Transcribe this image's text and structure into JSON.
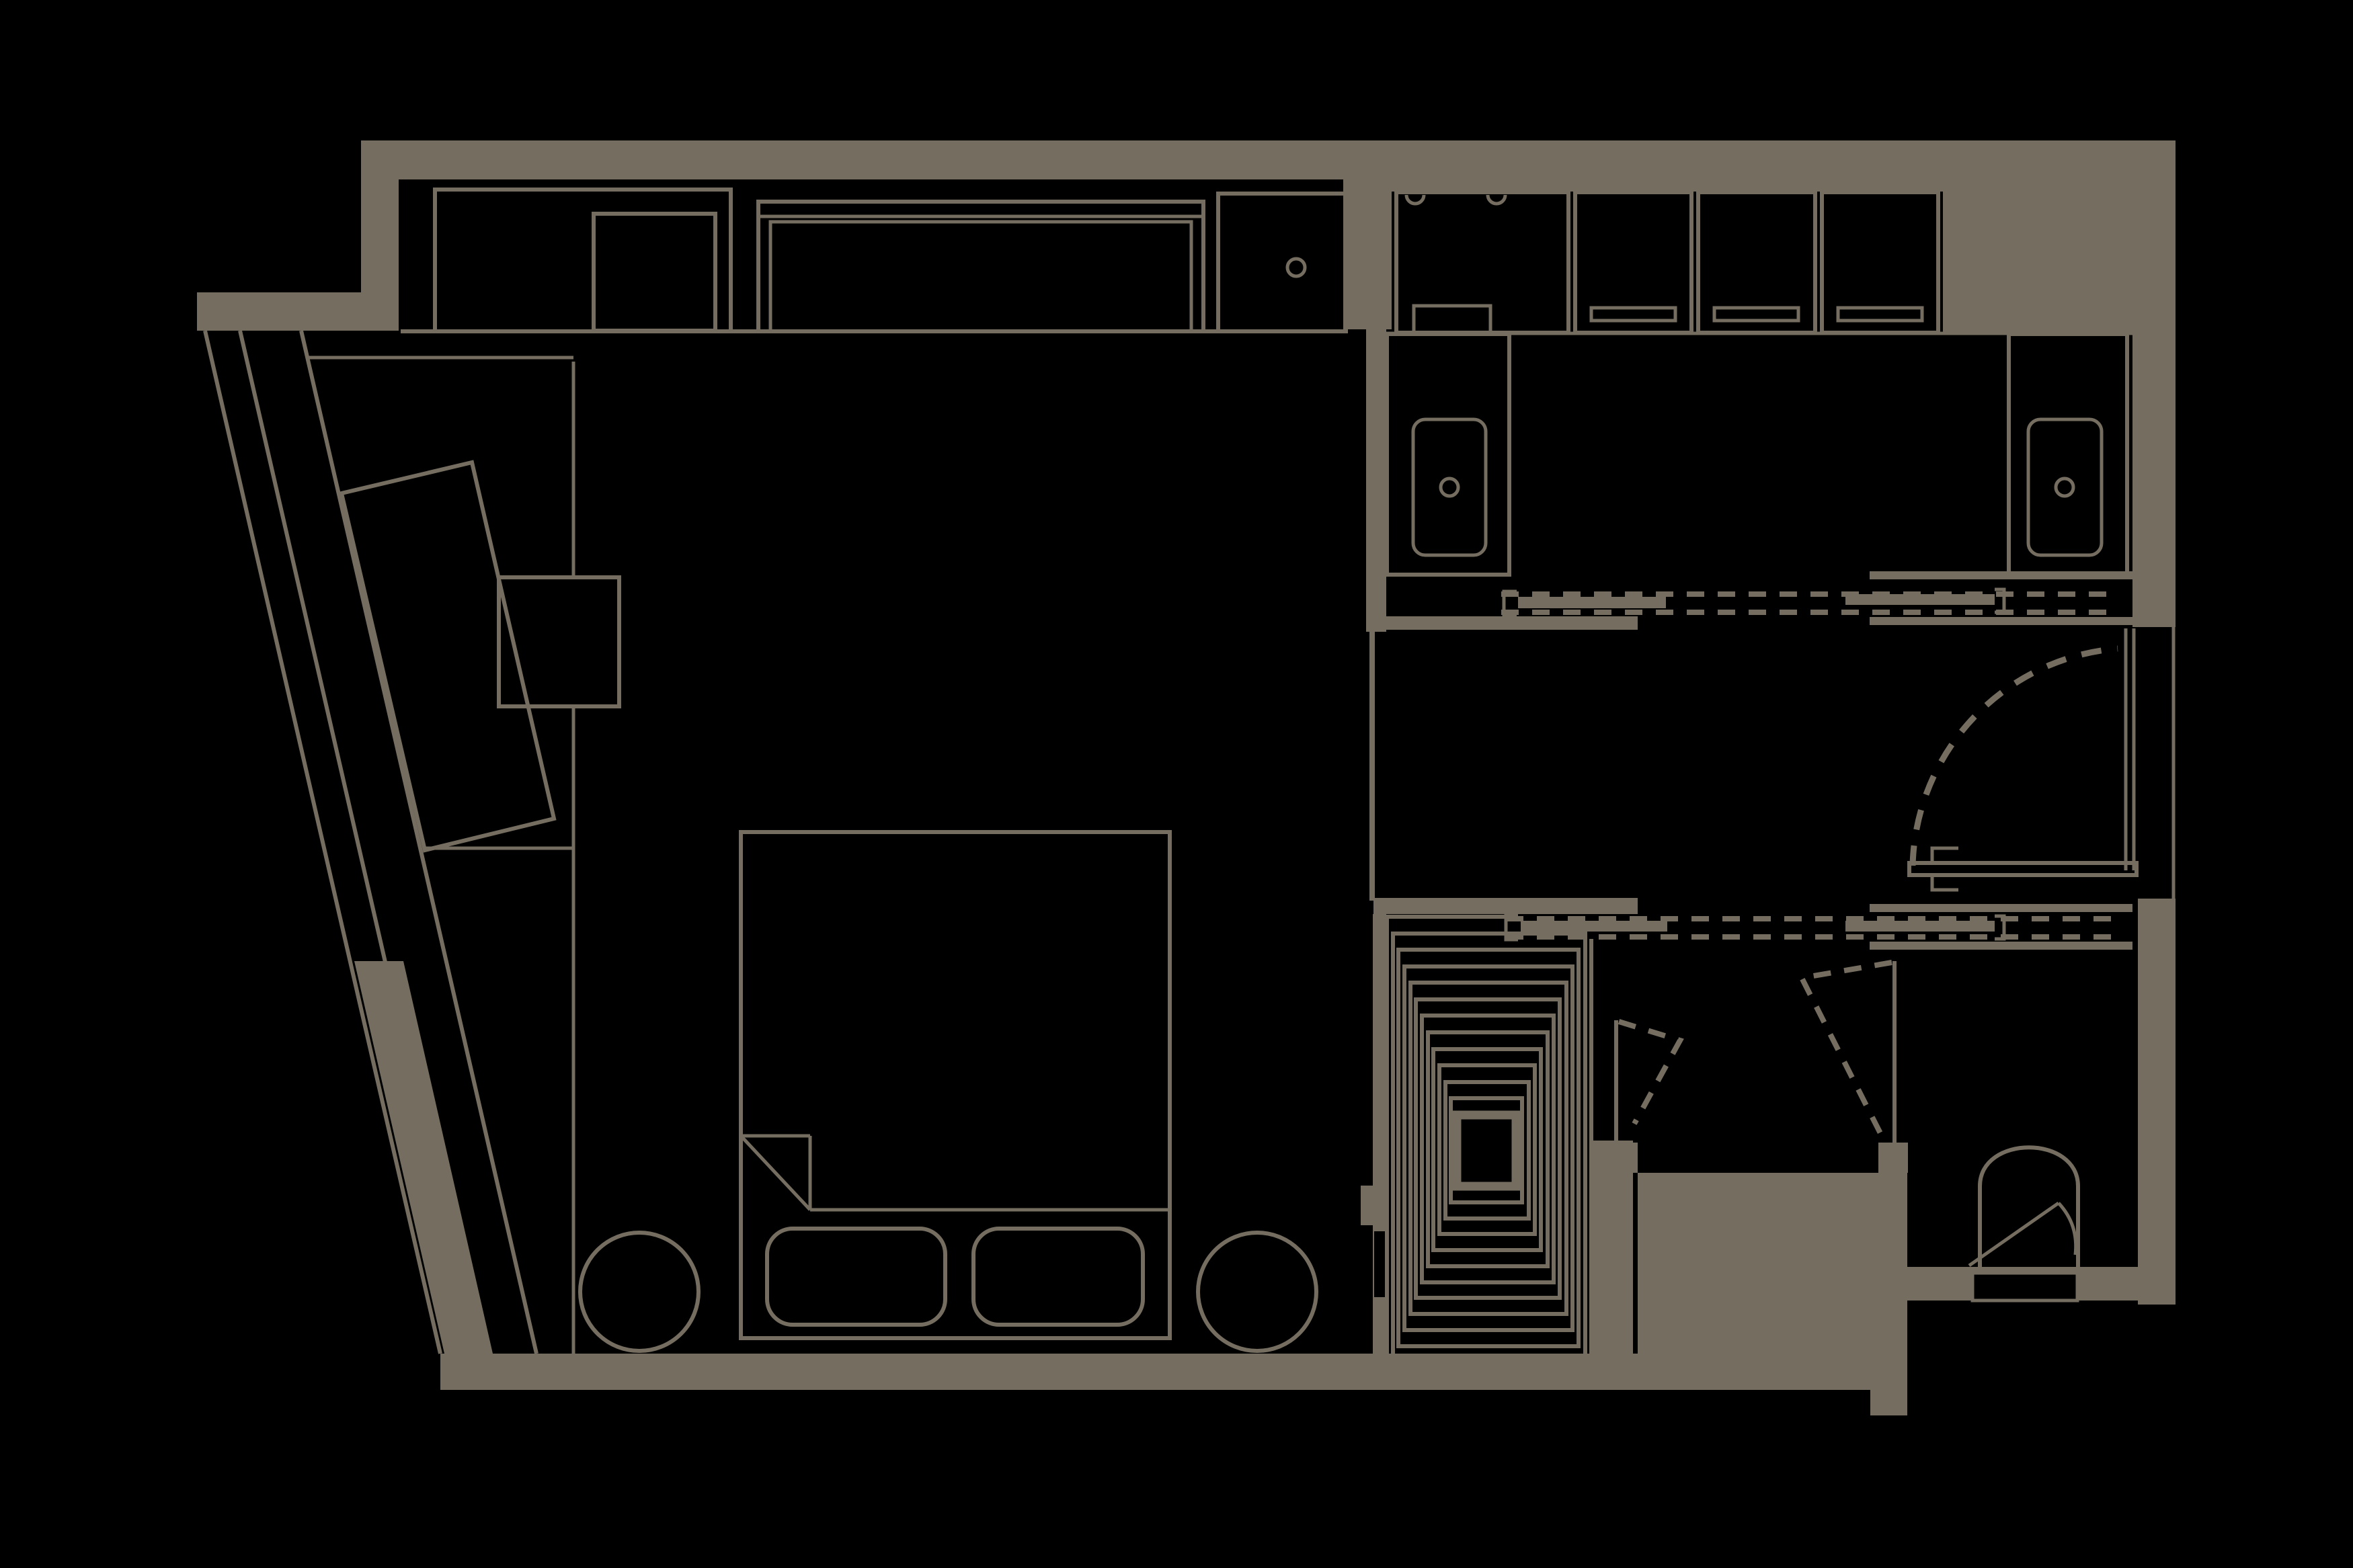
{
  "meta": {
    "title": "Apartment unit floor plan — black background with tan linework",
    "drawing_type": "architectural floor plan",
    "visible_text": "none"
  },
  "colors": {
    "background": "#000000",
    "line": "#756e60",
    "wall_fill": "#756e60"
  },
  "rooms": [
    {
      "name": "bedroom",
      "position": "left",
      "contents": [
        "closet row",
        "king bed",
        "foot bench cushions",
        "two round side tables",
        "tilted desk",
        "angled window wall"
      ]
    },
    {
      "name": "bathroom",
      "position": "top-right",
      "contents": [
        "shower cabin",
        "three lockers",
        "double vanity with basins",
        "pocket sliding door"
      ]
    },
    {
      "name": "entry-hall",
      "position": "middle-right",
      "contents": [
        "entry swing door",
        "sliding door pockets"
      ]
    },
    {
      "name": "stair",
      "position": "bottom-center",
      "contents": [
        "nested stair treads"
      ]
    },
    {
      "name": "wc",
      "position": "bottom-right",
      "contents": [
        "toilet",
        "swing door"
      ]
    }
  ],
  "fixtures": [
    "wardrobe",
    "console-unit",
    "cabinet-with-knob",
    "shower-cabin",
    "locker",
    "locker-slot",
    "vanity",
    "basin",
    "faucet-ring",
    "bed",
    "mattress-fold",
    "bench-cushion",
    "side-table",
    "tilted-desk",
    "desk-return",
    "stair-treads",
    "toilet",
    "entry-door",
    "swing-door",
    "sliding-door-panel"
  ],
  "doors": [
    {
      "name": "entry-door",
      "type": "swing",
      "wall": "right",
      "state": "shown open with dashed quarter-circle swing arc"
    },
    {
      "name": "bathroom-sliding-door",
      "type": "pocket slider",
      "panels": 2,
      "state": "open, dashed track"
    },
    {
      "name": "corridor-sliding-door",
      "type": "pocket slider",
      "panels": 2,
      "state": "open, dashed track"
    },
    {
      "name": "stair-swing-door",
      "type": "pivot leaf",
      "state": "dashed angular swing"
    },
    {
      "name": "wc-swing-door",
      "type": "pivot leaf",
      "state": "dashed angular swing"
    }
  ]
}
